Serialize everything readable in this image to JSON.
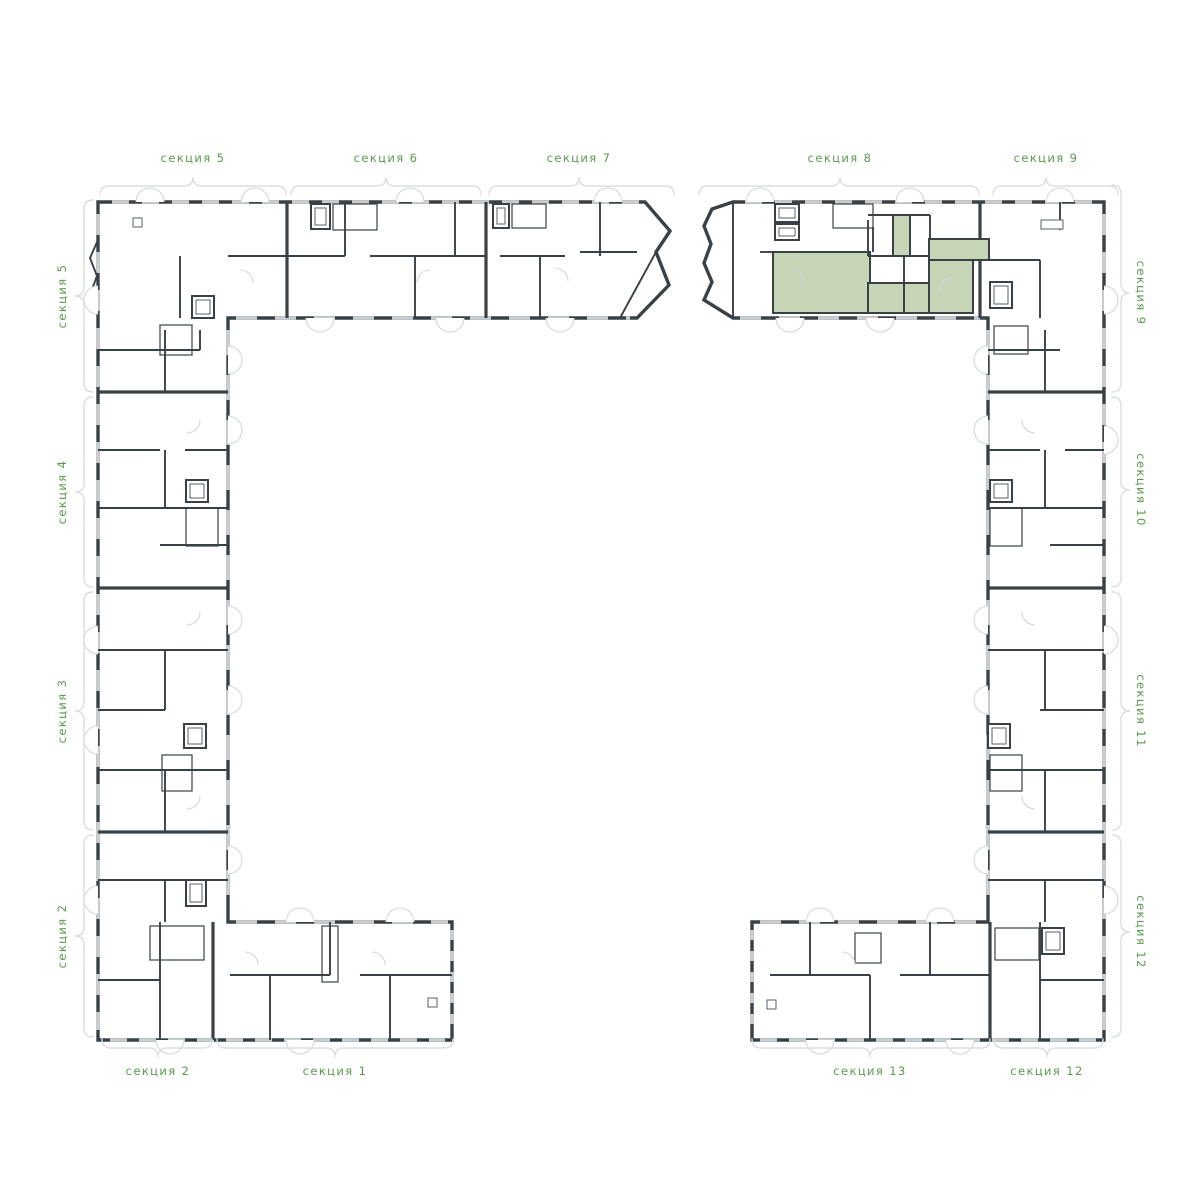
{
  "plan": {
    "labels_top": [
      "секция 5",
      "секция 6",
      "секция 7",
      "секция 8",
      "секция 9"
    ],
    "labels_left": [
      "секция 5",
      "секция 4",
      "секция 3",
      "секция 2"
    ],
    "labels_right": [
      "секция 9",
      "секция 10",
      "секция 11",
      "секция 12"
    ],
    "labels_bottom": [
      "секция 2",
      "секция 1",
      "секция 13",
      "секция 12"
    ],
    "highlighted_unit": {
      "section": "секция 8",
      "rooms": 6
    },
    "colors": {
      "wall": "#3a4146",
      "label": "#5a9a4e",
      "bracket": "#dcdedf",
      "window": "#c9cdd0",
      "hl": "#c6d5b6"
    }
  }
}
